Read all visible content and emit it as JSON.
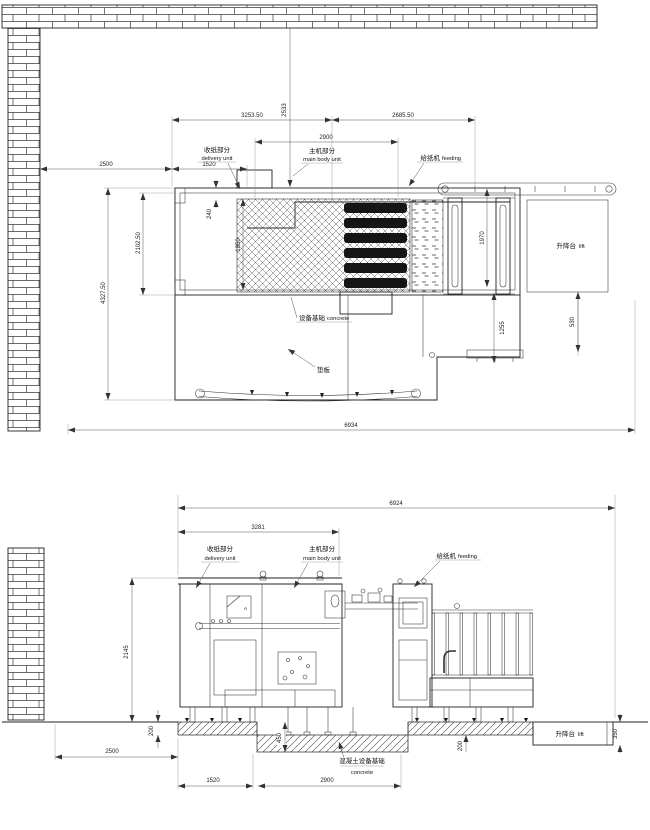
{
  "drawing": {
    "top_view": {
      "dims": {
        "wall_top": "2533",
        "width_left": "3253.50",
        "width_right": "2685.50",
        "main_body": "2900",
        "wall_left": "2500",
        "delivery": "1520",
        "total_depth": "4327.50",
        "inner_depth": "2102.50",
        "offset": "240",
        "conveyor": "1850",
        "feeder": "1970",
        "step_inner": "1255",
        "step_right": "530",
        "total_length": "6934"
      },
      "labels": {
        "delivery_cn": "收纸部分",
        "delivery_en": "delivery unit",
        "main_cn": "主机部分",
        "main_en": "main body unit",
        "feed_cn": "给纸机",
        "feed_en": "feeding",
        "lift_cn": "升降台",
        "lift_en": "lift",
        "found_cn": "设备基础",
        "found_en": "concrete",
        "pad": "垫板"
      }
    },
    "side_view": {
      "dims": {
        "total": "6924",
        "body": "3281",
        "height": "2145",
        "slab": "200",
        "wall": "2500",
        "pit_a": "1520",
        "pit_b": "2900",
        "pit_depth": "450",
        "slab_r": "200",
        "lift_depth": "350"
      },
      "labels": {
        "delivery_cn": "收纸部分",
        "delivery_en": "delivery unit",
        "main_cn": "主机部分",
        "main_en": "main body unit",
        "feed_cn": "给纸机",
        "feed_en": "feeding",
        "concrete_cn": "混凝土设备基础",
        "concrete_en": "concrete",
        "lift_cn": "升降台",
        "lift_en": "lift",
        "marker_a": "A"
      }
    }
  }
}
